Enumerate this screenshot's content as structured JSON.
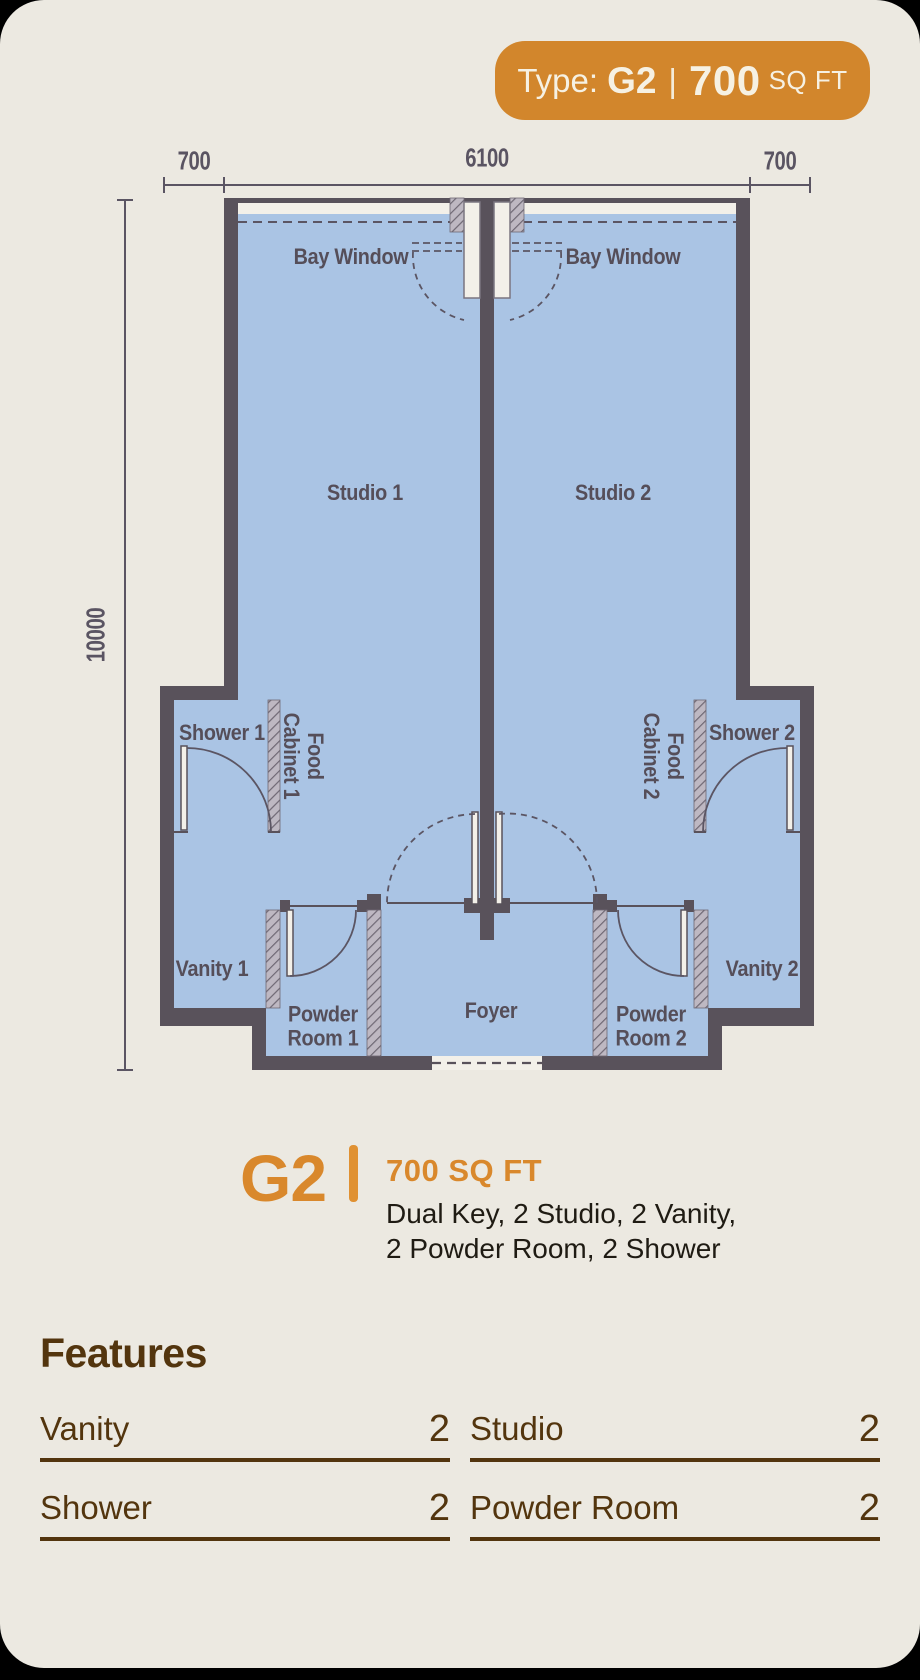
{
  "badge": {
    "prefix": "Type:",
    "code": "G2",
    "separator": "|",
    "area_value": "700",
    "area_unit": "SQ FT"
  },
  "plan": {
    "dimensions": {
      "top_left": "700",
      "top_center": "6100",
      "top_right": "700",
      "side": "10000"
    },
    "rooms": {
      "bay_window_1": "Bay Window",
      "bay_window_2": "Bay Window",
      "studio_1": "Studio 1",
      "studio_2": "Studio 2",
      "shower_1": "Shower 1",
      "shower_2": "Shower 2",
      "food_cabinet_1_line1": "Food",
      "food_cabinet_1_line2": "Cabinet 1",
      "food_cabinet_2_line1": "Food",
      "food_cabinet_2_line2": "Cabinet 2",
      "vanity_1": "Vanity 1",
      "vanity_2": "Vanity 2",
      "powder_room_1_line1": "Powder",
      "powder_room_1_line2": "Room 1",
      "powder_room_2_line1": "Powder",
      "powder_room_2_line2": "Room 2",
      "foyer": "Foyer"
    }
  },
  "summary": {
    "code": "G2",
    "area": "700 SQ FT",
    "description_line1": "Dual Key, 2 Studio, 2 Vanity,",
    "description_line2": "2 Powder Room, 2 Shower"
  },
  "features": {
    "heading": "Features",
    "items": [
      {
        "label": "Vanity",
        "count": "2"
      },
      {
        "label": "Studio",
        "count": "2"
      },
      {
        "label": "Shower",
        "count": "2"
      },
      {
        "label": "Powder Room",
        "count": "2"
      }
    ]
  },
  "colors": {
    "card_background": "#ece9e1",
    "accent_orange": "#d2862c",
    "wall": "#59525b",
    "floor_blue": "#aac4e4",
    "feature_brown": "#53350e"
  }
}
